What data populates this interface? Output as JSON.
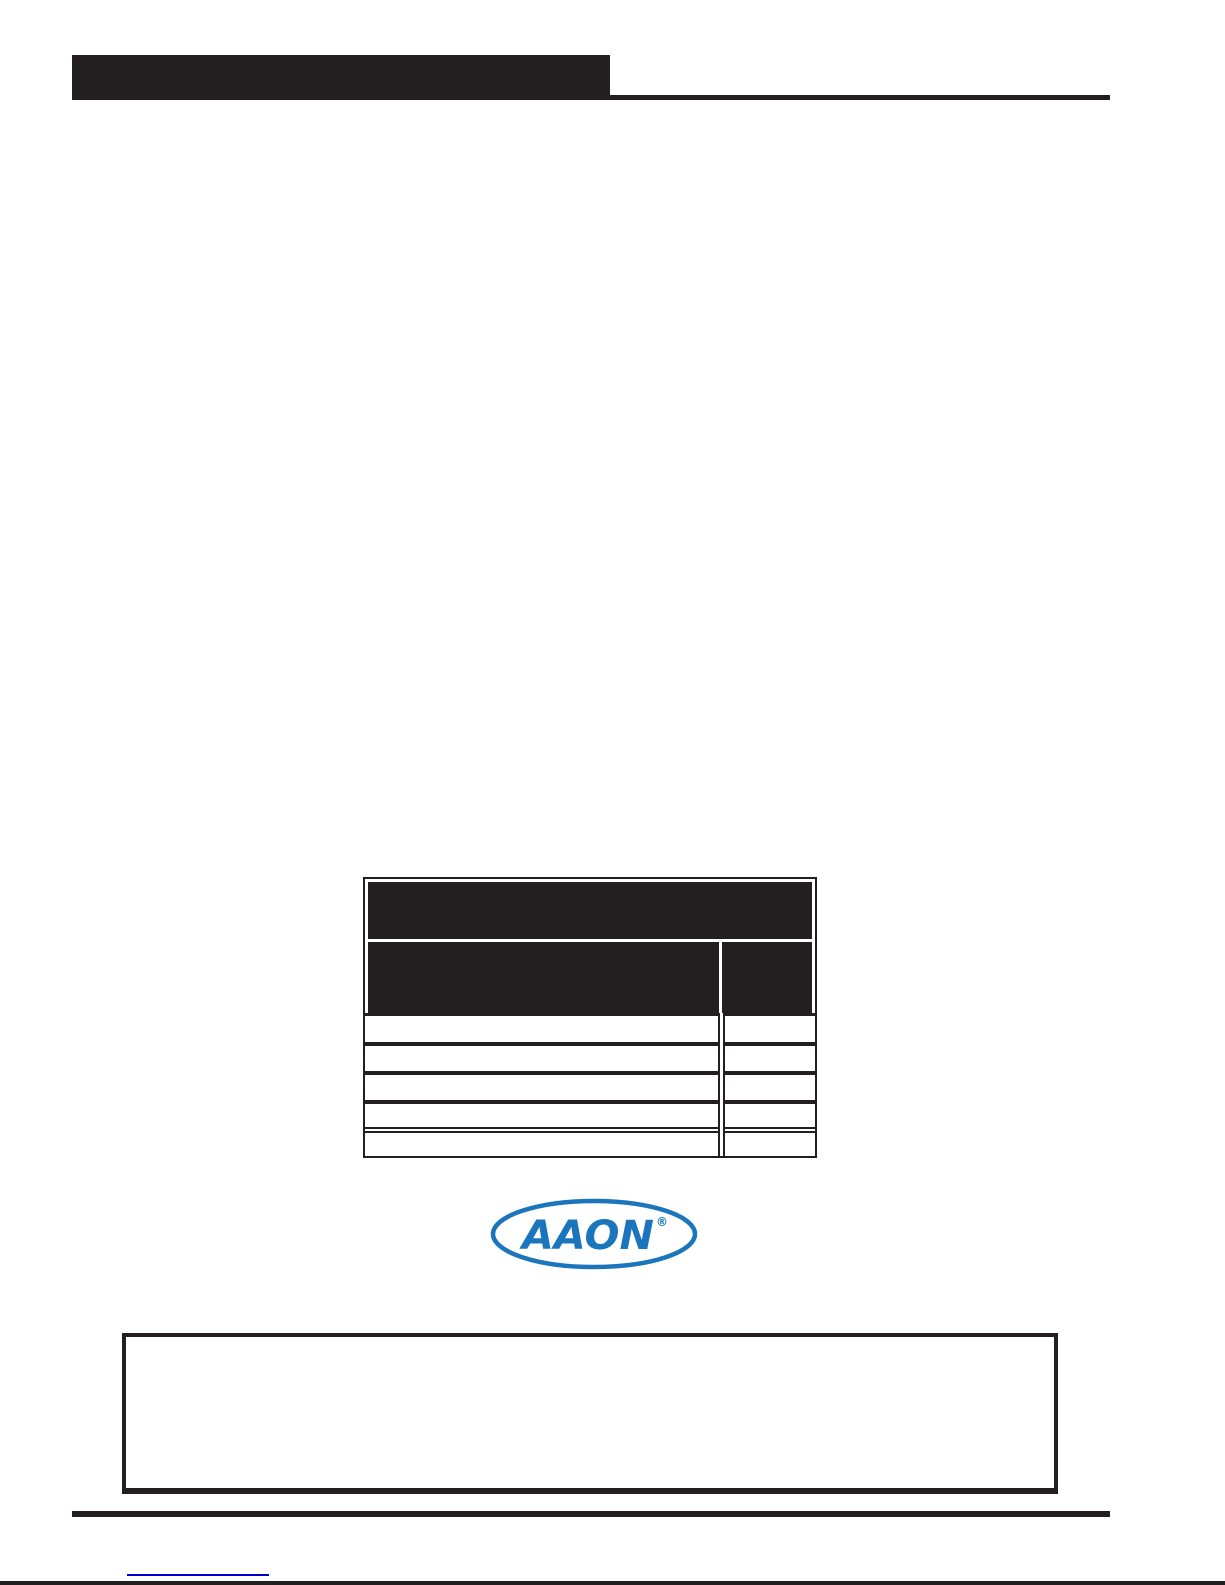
{
  "colors": {
    "ink": "#231f20",
    "logo-blue": "#1b75bc",
    "link-blue": "#0000cc",
    "page-bg": "#ffffff"
  },
  "header": {
    "bar_label": ""
  },
  "table": {
    "header_row1_label": "",
    "header_row2_col1_label": "",
    "header_row2_col2_label": "",
    "rows": [
      {
        "col1": "",
        "col2": ""
      },
      {
        "col1": "",
        "col2": ""
      },
      {
        "col1": "",
        "col2": ""
      },
      {
        "col1": "",
        "col2": ""
      },
      {
        "col1": "",
        "col2": ""
      }
    ]
  },
  "logo": {
    "text": "AAON",
    "registered_mark": "®",
    "color": "#1b75bc"
  },
  "notice_box": {
    "text": ""
  },
  "footer": {
    "link_text": "",
    "link_color": "#0000cc"
  }
}
